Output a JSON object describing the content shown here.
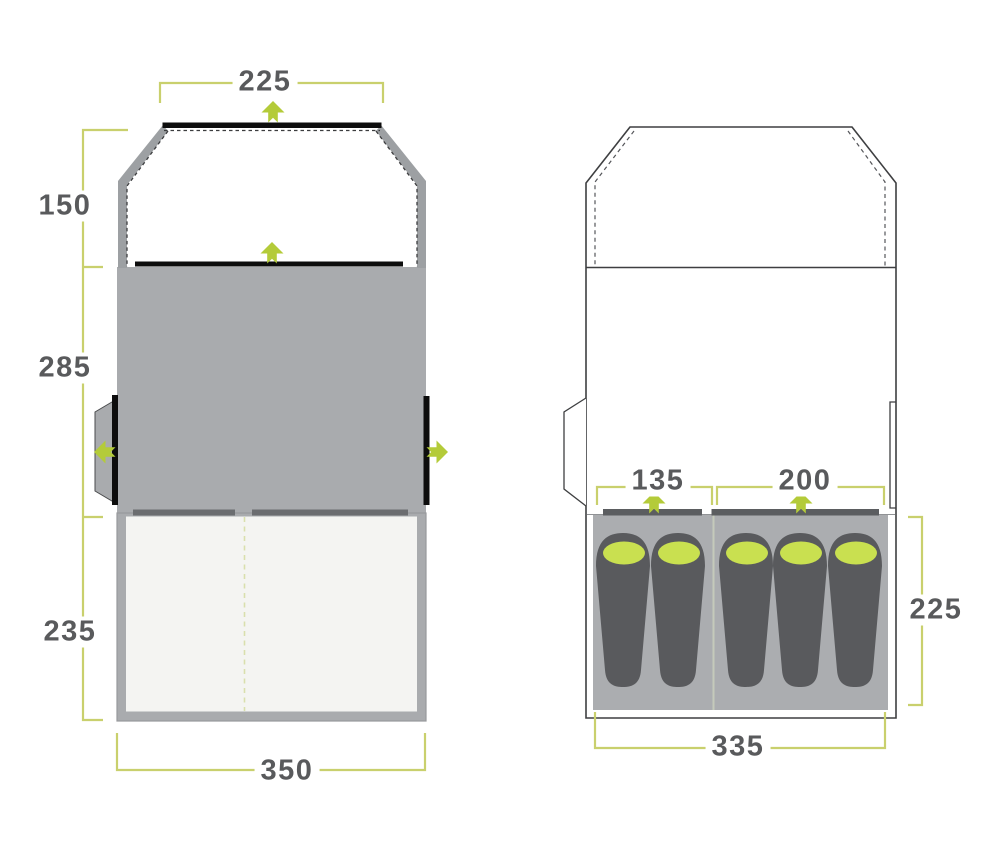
{
  "diagram": {
    "type": "tent-floorplan-dimensions",
    "units_note": "",
    "colors": {
      "background": "#ffffff",
      "dimension_line": "#c9d06d",
      "dimension_text": "#595a5c",
      "accent_lime": "#b4cb39",
      "sleeping_bag_hood_lime": "#c9e050",
      "tent_grey": "#a9abae",
      "wall_band_grey": "#9da0a3",
      "door_bar_grey": "#6b6d70",
      "sleeping_bag_grey": "#595a5d",
      "outline_dark": "#3e3f41",
      "floor_white": "#f4f4f2",
      "black_door_line": "#0d0d0d"
    }
  },
  "left_view": {
    "name": "groundplan-overview",
    "dimensions": {
      "rear_width": "225",
      "rear_depth": "150",
      "living_depth": "285",
      "front_depth": "235",
      "total_width": "350"
    },
    "door_arrows": [
      "up-rear",
      "up-inner",
      "left-side",
      "right-side"
    ]
  },
  "right_view": {
    "name": "bedroom-layout",
    "dimensions": {
      "small_bedroom_width": "135",
      "large_bedroom_width": "200",
      "bedroom_depth": "225",
      "bedroom_total_width": "335"
    },
    "sleeping_bag_count": 5,
    "bedroom_arrows": [
      "up-small-bedroom",
      "up-large-bedroom"
    ]
  }
}
